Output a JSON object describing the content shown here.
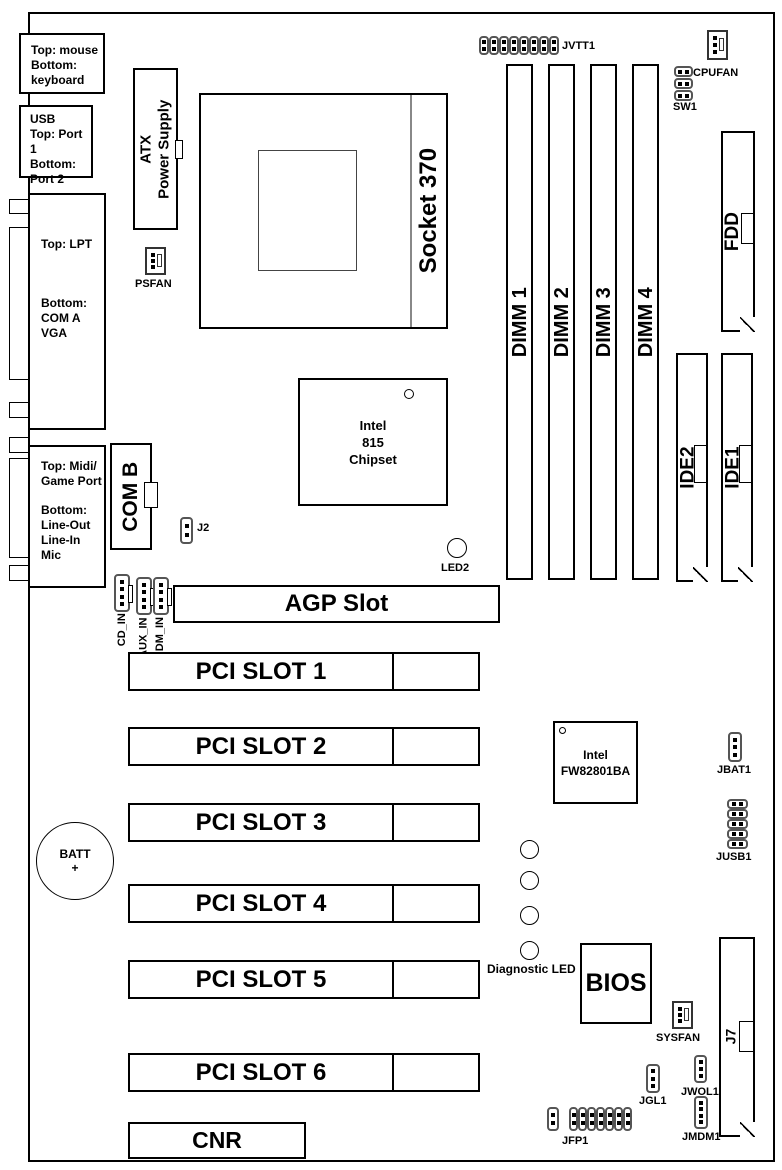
{
  "rear_ports": {
    "mouse_kb": [
      "Top: mouse",
      "Bottom:",
      "keyboard"
    ],
    "usb": [
      "USB",
      "Top: Port 1",
      "Bottom:",
      "Port 2"
    ],
    "lpt": {
      "top": "Top: LPT",
      "bottom": [
        "Bottom:",
        "COM A",
        "VGA"
      ]
    },
    "midi": {
      "top": [
        "Top: Midi/",
        "Game Port"
      ],
      "bottom": [
        "Bottom:",
        "Line-Out",
        "Line-In",
        "Mic"
      ]
    },
    "com_b": "COM B"
  },
  "power": {
    "atx": [
      "ATX",
      "Power Supply"
    ],
    "psfan": "PSFAN"
  },
  "cpu": {
    "socket": "Socket 370"
  },
  "chips": {
    "chipset": [
      "Intel",
      "815",
      "Chipset"
    ],
    "ich": [
      "Intel",
      "FW82801BA"
    ],
    "bios": "BIOS"
  },
  "memory": {
    "dimm": [
      "DIMM 1",
      "DIMM 2",
      "DIMM 3",
      "DIMM 4"
    ]
  },
  "storage": {
    "fdd": "FDD",
    "ide2": "IDE2",
    "ide1": "IDE1"
  },
  "slots": {
    "agp": "AGP Slot",
    "pci": [
      "PCI SLOT 1",
      "PCI SLOT 2",
      "PCI SLOT 3",
      "PCI SLOT 4",
      "PCI SLOT 5",
      "PCI SLOT 6"
    ],
    "cnr": "CNR",
    "j7": "J7"
  },
  "headers": {
    "jvtt1": "JVTT1",
    "cpufan": "CPUFAN",
    "sw1": "SW1",
    "sysfan": "SYSFAN",
    "j2": "J2",
    "jbat1": "JBAT1",
    "jusb1": "JUSB1",
    "jgl1": "JGL1",
    "jwol1": "JWOL1",
    "jmdm1": "JMDM1",
    "jfp1": "JFP1",
    "cd_in": "CD_IN",
    "aux_in": "AUX_IN",
    "mdm_in": "MDM_IN"
  },
  "indicators": {
    "led2": "LED2",
    "diagnostic_led": "Diagnostic LED",
    "batt": [
      "BATT",
      "+"
    ]
  }
}
